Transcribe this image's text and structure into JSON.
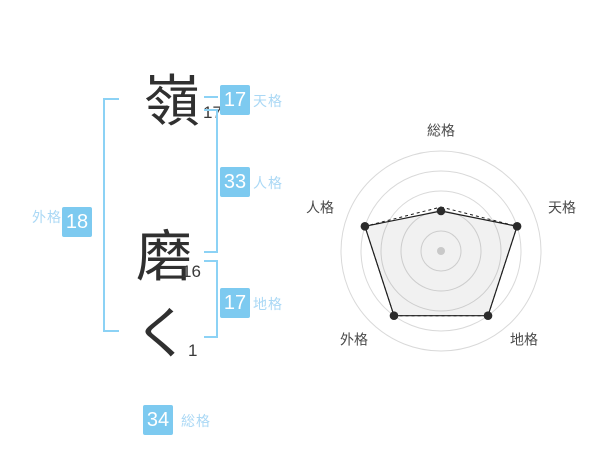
{
  "name_analysis": {
    "characters": [
      {
        "char": "嶺",
        "strokes": "17"
      },
      {
        "char": "磨",
        "strokes": "16"
      },
      {
        "char": "く",
        "strokes": "1"
      }
    ],
    "categories": {
      "tenkaku": {
        "label": "天格",
        "value": "17"
      },
      "jinkaku": {
        "label": "人格",
        "value": "33"
      },
      "chikaku": {
        "label": "地格",
        "value": "17"
      },
      "gaikaku": {
        "label": "外格",
        "value": "18"
      },
      "soukaku": {
        "label": "総格",
        "value": "34"
      }
    },
    "colors": {
      "accent_blue": "#7dcaf0",
      "label_blue": "#aad8f5",
      "bracket_blue": "#8cd2f5",
      "text_dark": "#303030"
    }
  },
  "chart_data": {
    "type": "radar",
    "categories": [
      "総格",
      "天格",
      "地格",
      "外格",
      "人格"
    ],
    "series": [
      {
        "name": "score",
        "style": "solid",
        "values": [
          2,
          4,
          4,
          4,
          4
        ]
      },
      {
        "name": "score-overlay",
        "style": "dashed",
        "values": [
          2.2,
          4,
          4,
          4,
          4
        ]
      }
    ],
    "scale_max": 5,
    "rings": 5,
    "grid": "circular",
    "legend": "none",
    "colors": {
      "ring": "#d9d9d9",
      "line": "#1f1f1f",
      "fill": "rgba(0,0,0,0.055)",
      "dot": "#2b2b2b",
      "center_dot": "#c9c9c9",
      "label": "#4a4a4a"
    }
  }
}
